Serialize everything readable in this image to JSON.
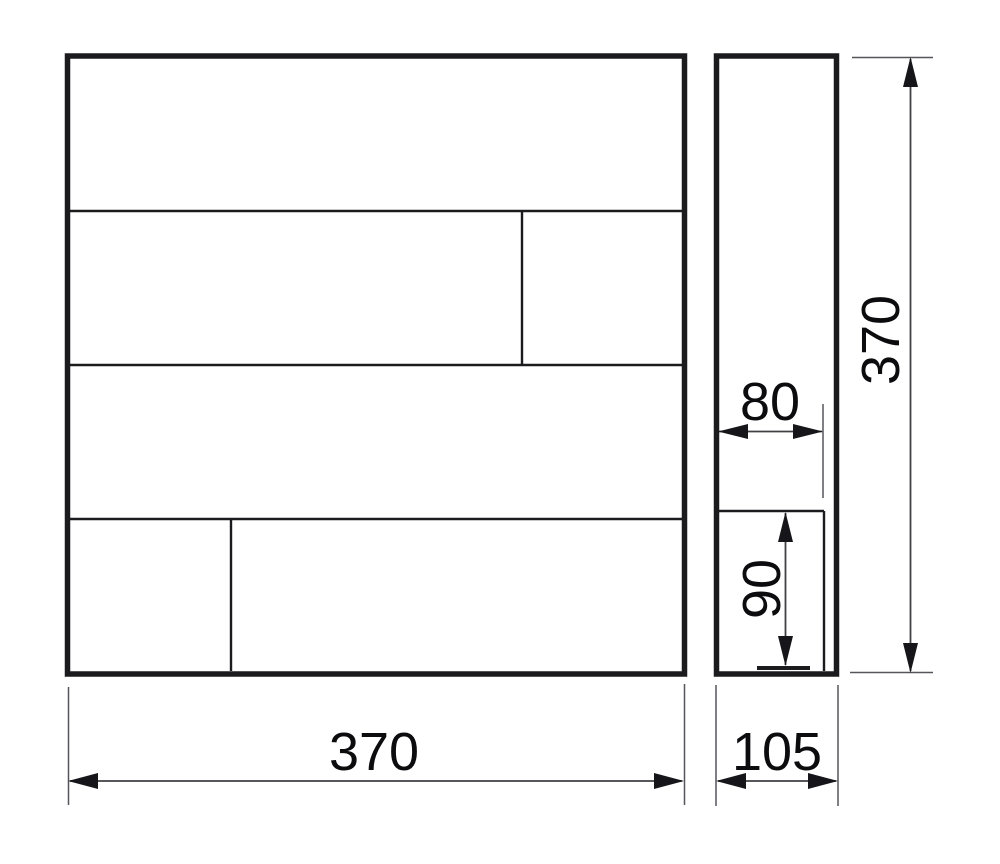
{
  "colors": {
    "background": "#ffffff",
    "body_line": "#1b1b1e",
    "dimension_line": "#404045",
    "text": "#0c0c0e"
  },
  "dims": {
    "front_width": "370",
    "side_depth": "105",
    "overall_height": "370",
    "slot_width": "80",
    "slot_depth": "90"
  }
}
